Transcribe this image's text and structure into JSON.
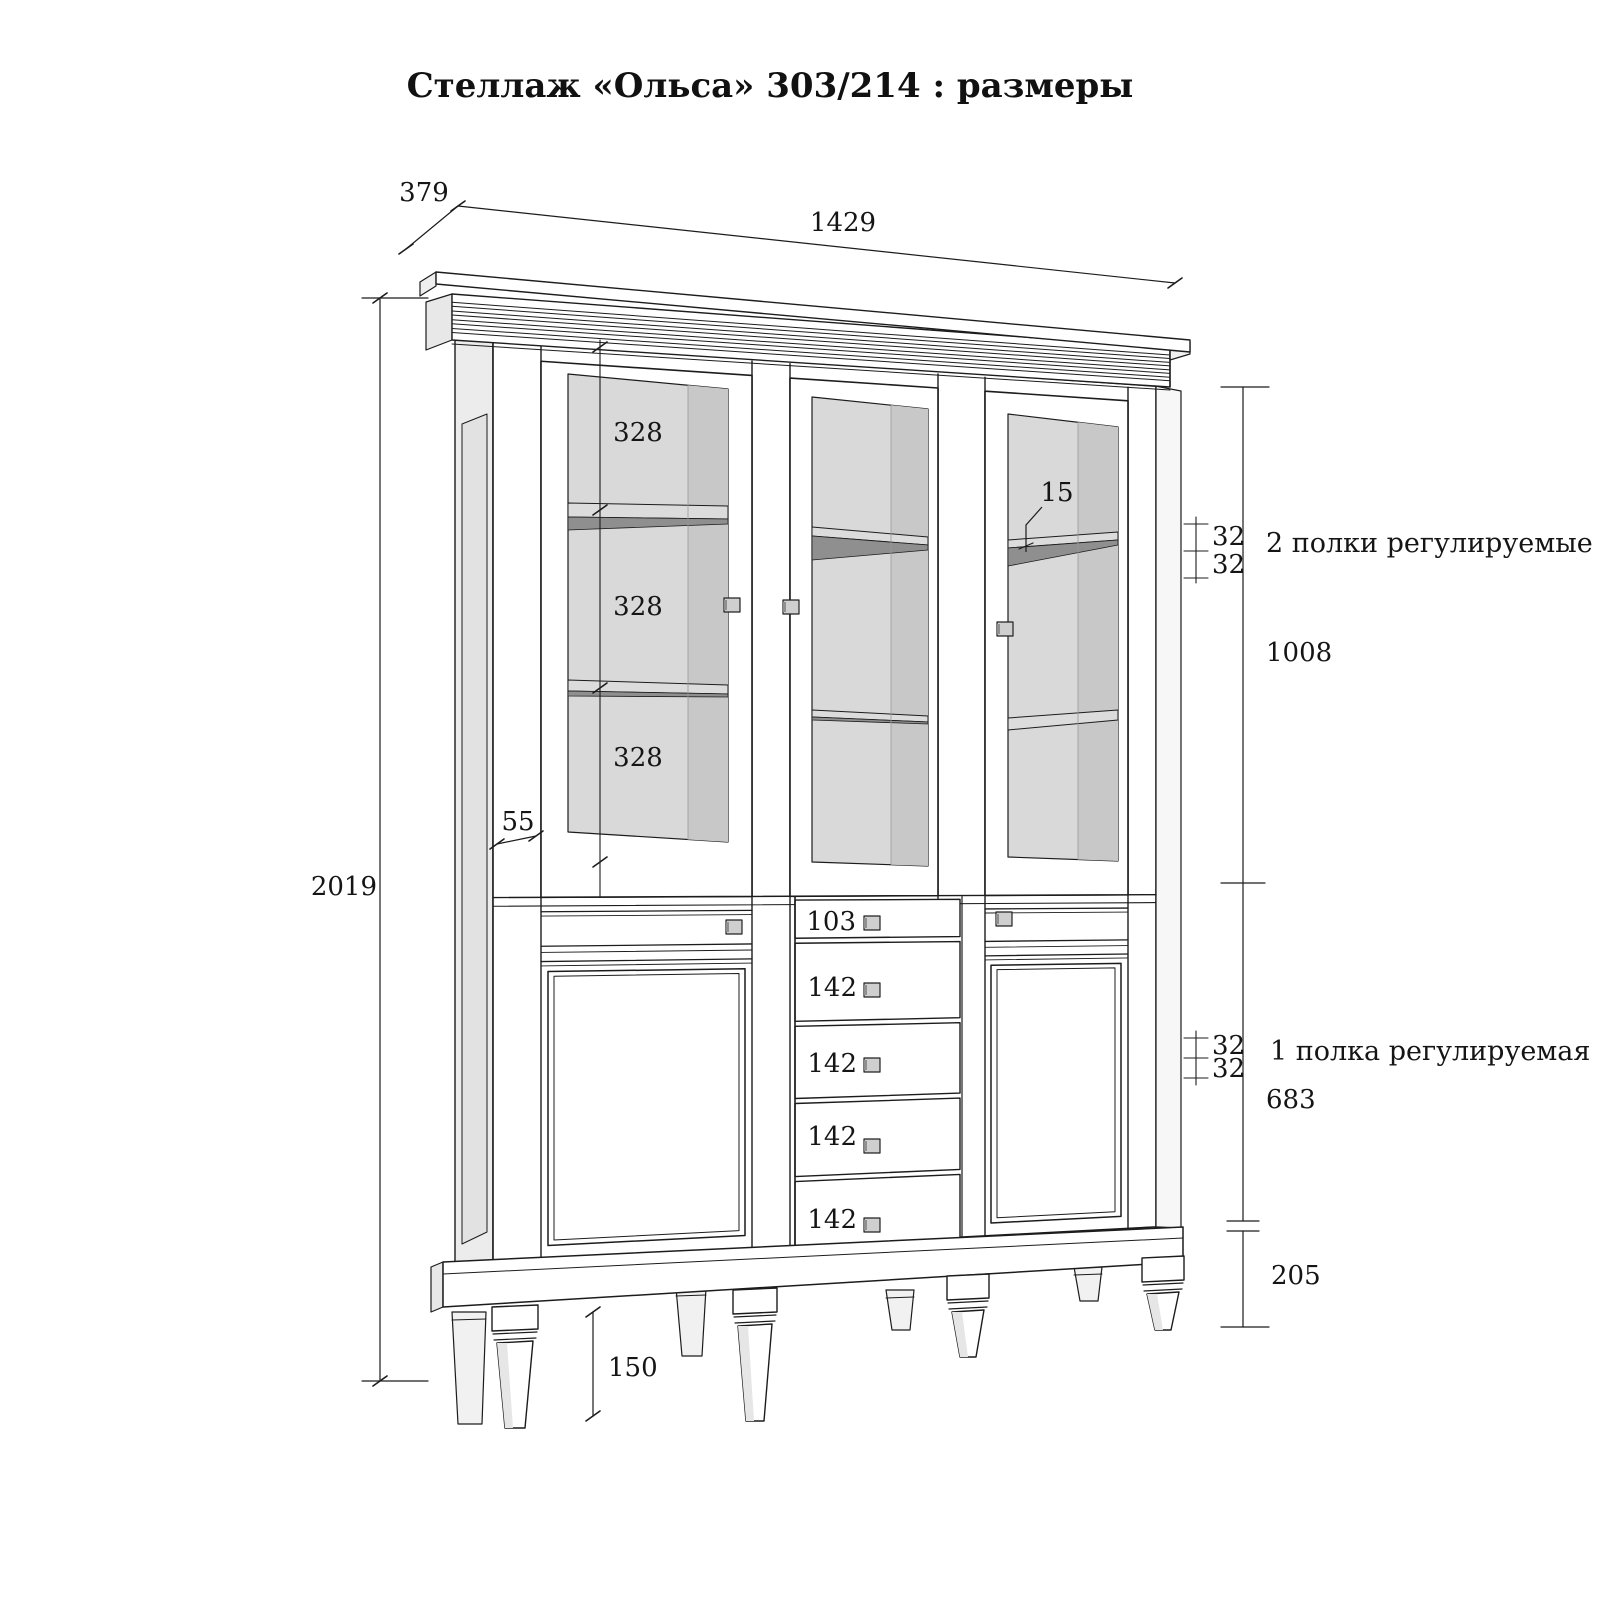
{
  "title": "Стеллаж «Ольса» 303/214 : размеры",
  "dimensions": {
    "depth": "379",
    "width": "1429",
    "height": "2019",
    "shelf_gaps": [
      "328",
      "328",
      "328"
    ],
    "door_stile_width": "55",
    "shelf_thickness": "15",
    "pin_spacing_top": [
      "32",
      "32"
    ],
    "top_section_height": "1008",
    "pin_spacing_bottom": [
      "32",
      "32"
    ],
    "bottom_section_height": "683",
    "base_height": "205",
    "leg_height": "150",
    "drawer_heights": [
      "103",
      "142",
      "142",
      "142",
      "142"
    ]
  },
  "annotations": {
    "top_shelves": "2 полки регулируемые",
    "bottom_shelf": "1 полка регулируемая"
  }
}
